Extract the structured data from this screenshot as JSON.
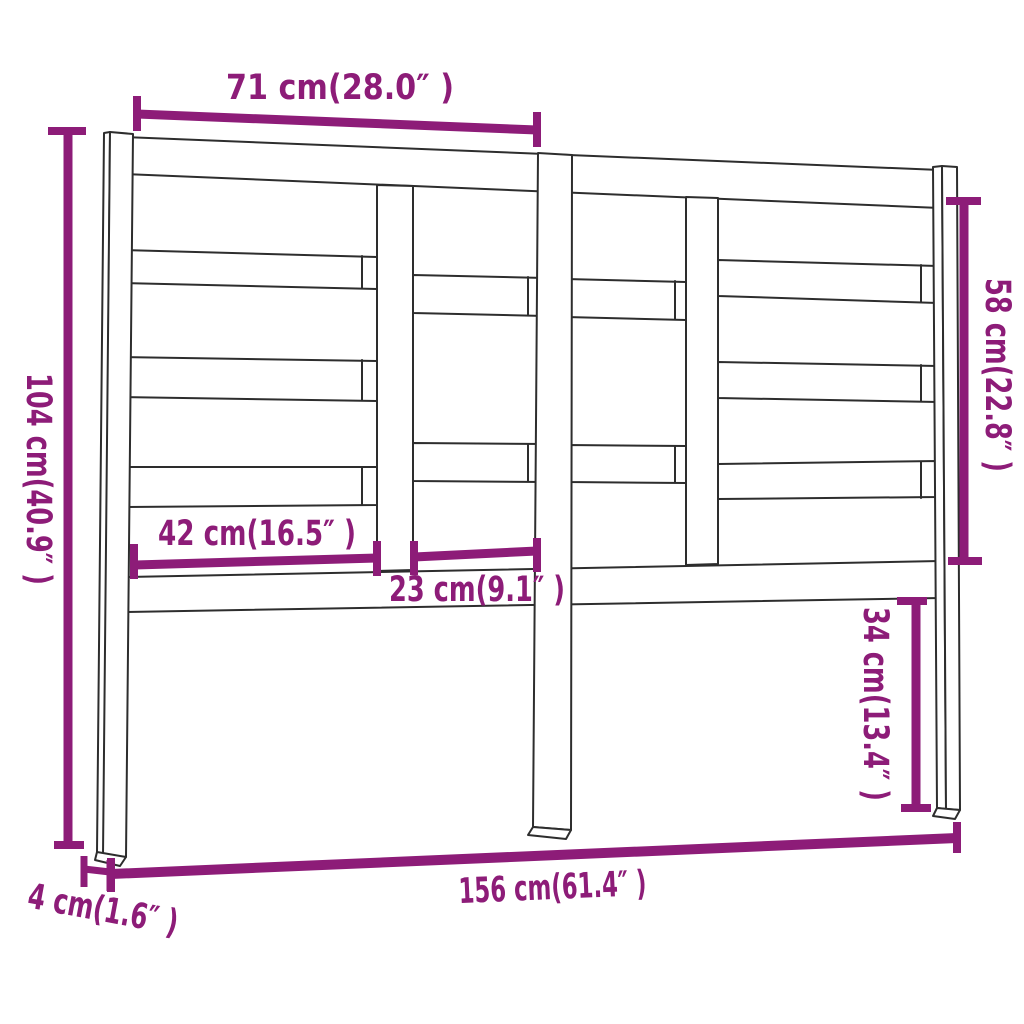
{
  "colors": {
    "accent": "#8d1c78",
    "outline": "#2d2d2d",
    "background": "#ffffff"
  },
  "dimensions": {
    "top_width": {
      "label": "71 cm(28.0″ )",
      "cm": 71,
      "inches": 28.0,
      "orientation": "horizontal"
    },
    "total_height": {
      "label": "104 cm(40.9″ )",
      "cm": 104,
      "inches": 40.9,
      "orientation": "vertical"
    },
    "slat_area_height": {
      "label": "58 cm(22.8″ )",
      "cm": 58,
      "inches": 22.8,
      "orientation": "vertical"
    },
    "left_panel_width": {
      "label": "42 cm(16.5″ )",
      "cm": 42,
      "inches": 16.5,
      "orientation": "horizontal"
    },
    "center_panel_width": {
      "label": "23 cm(9.1″ )",
      "cm": 23,
      "inches": 9.1,
      "orientation": "horizontal"
    },
    "leg_below_height": {
      "label": "34 cm(13.4″ )",
      "cm": 34,
      "inches": 13.4,
      "orientation": "vertical"
    },
    "total_width": {
      "label": "156 cm(61.4″ )",
      "cm": 156,
      "inches": 61.4,
      "orientation": "horizontal"
    },
    "depth": {
      "label": "4 cm(1.6″ )",
      "cm": 4,
      "inches": 1.6,
      "orientation": "horizontal"
    }
  }
}
